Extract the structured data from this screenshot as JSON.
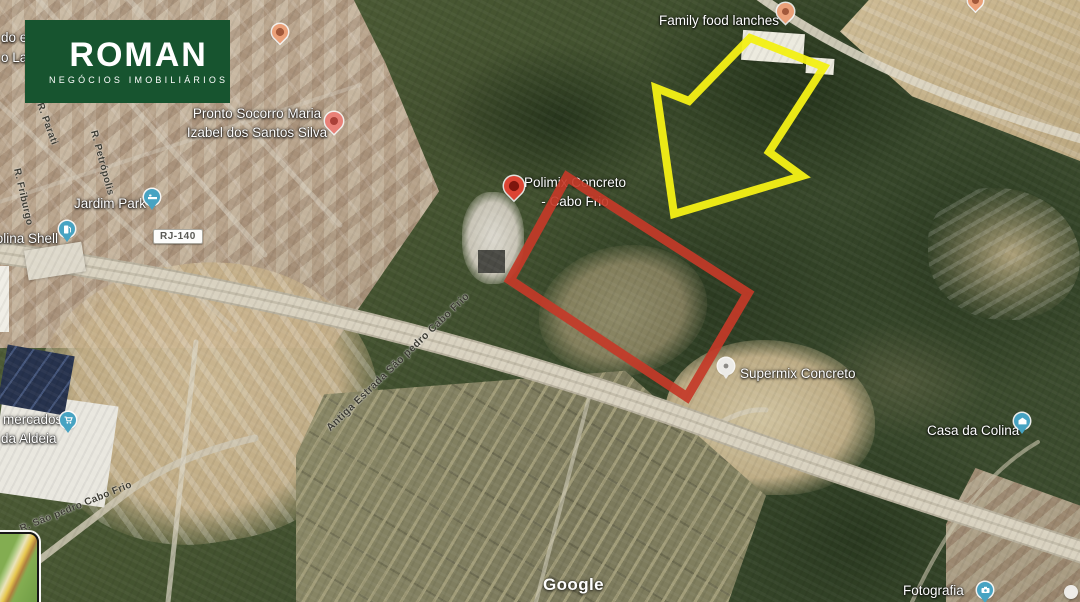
{
  "logo": {
    "brand": "ROMAN",
    "tagline": "NEGÓCIOS IMOBILIÁRIOS"
  },
  "attribution": "Google",
  "road_labels": {
    "shield": "RJ-140",
    "antiga_estrada": "Antiga Estrada São pedro Cabo Frio",
    "sao_pedro": "R. São pedro Cabo Frio",
    "friburgo": "R. Friburgo",
    "petropolis": "R. Petrópolis",
    "parati": "R. Parati"
  },
  "edge_fragments": {
    "top": "do e",
    "bottom": "o Lan"
  },
  "places": {
    "beesfilha": {
      "name": "Beesfilha"
    },
    "pronto_socorro": {
      "line1": "Pronto Socorro Maria",
      "line2": "Izabel dos Santos Silva"
    },
    "jardim_park": {
      "name": "Jardim Park"
    },
    "colina_shell": {
      "name": "Colina Shell"
    },
    "polimix": {
      "line1": "Polimix Concreto",
      "line2": "- Cabo Frio"
    },
    "family_food": {
      "name": "Family food lanches"
    },
    "supermix": {
      "name": "Supermix Concreto"
    },
    "casa_da_colina": {
      "name": "Casa da Colina"
    },
    "mercados": {
      "line1": "mercados",
      "line2": "da Aldeia"
    },
    "fotografia": {
      "name": "Fotografia"
    }
  },
  "colors": {
    "annotation_red": "#c43a28",
    "annotation_yellow": "#f2ef16",
    "logo_green": "#17542f",
    "logo_red": "#e2402a",
    "pin_blue": "#47a3c2",
    "pin_generic": "#eba078",
    "pin_red": "#dc4433",
    "pin_salmon": "#e98077",
    "pin_gray": "#ecebe7"
  }
}
